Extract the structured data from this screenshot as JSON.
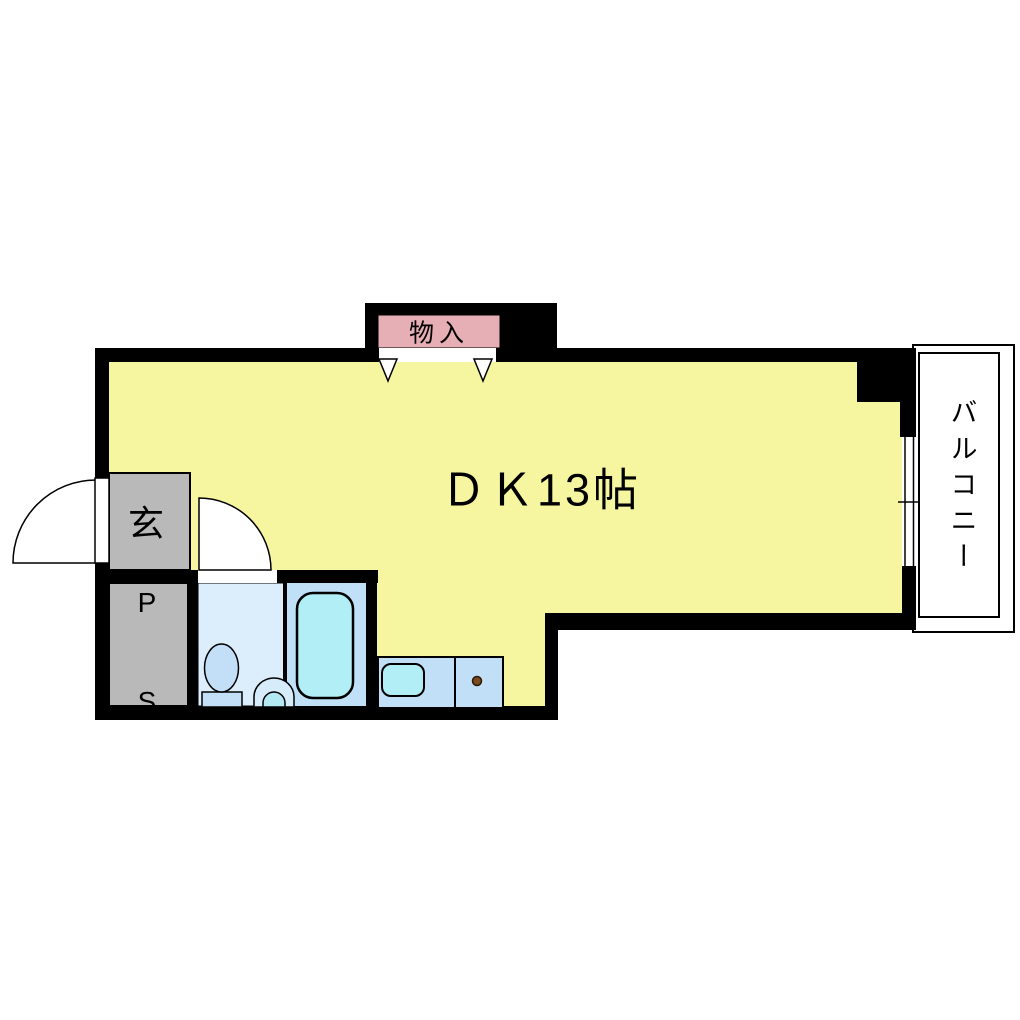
{
  "labels": {
    "dining_kitchen": "ＤＫ13帖",
    "storage": "物入",
    "entrance": "玄",
    "pipe_shaft_line1": "P",
    "pipe_shaft_line2": "S",
    "balcony": "バルコニー"
  },
  "colors": {
    "wall": "#000000",
    "room_fill": "#f6f6a1",
    "storage_fill": "#e6aeb5",
    "storage_opening_fill": "#ffffff",
    "entrance_fill": "#b9b9b9",
    "pipe_shaft_fill": "#b9b9b9",
    "bathroom_floor_fill": "#dceefb",
    "bath_area_fill": "#bfe0f7",
    "bathtub_fill": "#b2eef5",
    "toilet_bowl_fill": "#c3dff8",
    "toilet_tank_fill": "#c3dff8",
    "washbasin_fill": "#d6ecfb",
    "washbasin_inner_fill": "#b2e9f2",
    "counter_fill": "#c2dff8",
    "counter_sink_fill": "#b2eef5",
    "burner_fill": "#7b4b1f",
    "door_leaf_fill": "#ffffff",
    "balcony_fill": "#ffffff",
    "window_fill": "#ffffff",
    "text_color": "#000000"
  }
}
